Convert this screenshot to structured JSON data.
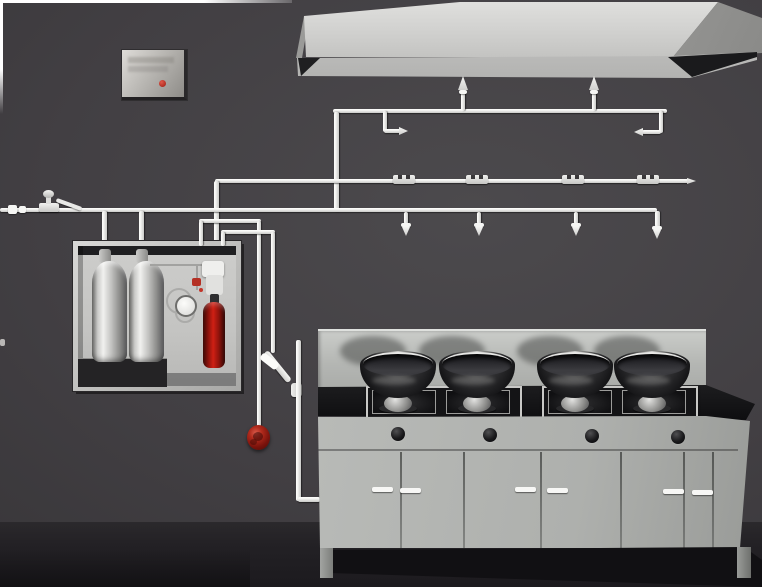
{
  "scene": {
    "title": "3D illustration of a commercial kitchen fire suppression system",
    "text_visible": "",
    "components": {
      "control_panel": {
        "name": "wall-mounted alarm control panel",
        "body_color": "#bdbbb7",
        "indicator_color": "#c0281c"
      },
      "exhaust_hood": {
        "name": "stainless exhaust hood",
        "color": "#d0d0ce"
      },
      "hood_pipe": {
        "name": "hood and duct agent pipe",
        "upward_nozzles": 2,
        "inward_duct_nozzles": 2
      },
      "detection_pipe": {
        "name": "fusible-link detection line",
        "link_brackets": 4,
        "tapered_end": true
      },
      "appliance_pipe": {
        "name": "appliance protection branch line",
        "downward_nozzles": 4
      },
      "supply_valve": {
        "name": "manual shut-off valve with lever",
        "color": "#e8e8e6"
      },
      "agent_cabinet": {
        "name": "agent storage cabinet",
        "cylinders": 2,
        "cylinder_color": "#e6e6e4",
        "cartridge_color": "#b01a10",
        "gauge": 1
      },
      "pull_station": {
        "name": "remote release ball",
        "color": "#9a1810"
      },
      "release_arm": {
        "name": "angled release arm with fitting"
      },
      "range": {
        "name": "four-burner wok range",
        "woks": 4,
        "burner_stations": 2,
        "control_knobs": 4,
        "door_handles": 6,
        "body_color": "#b2b4b1",
        "top_color": "#151517"
      }
    },
    "colors": {
      "wall": "#423f43",
      "floor": "#232125",
      "pipe": "#eeeeec",
      "frame_border": "#ffffff"
    }
  }
}
